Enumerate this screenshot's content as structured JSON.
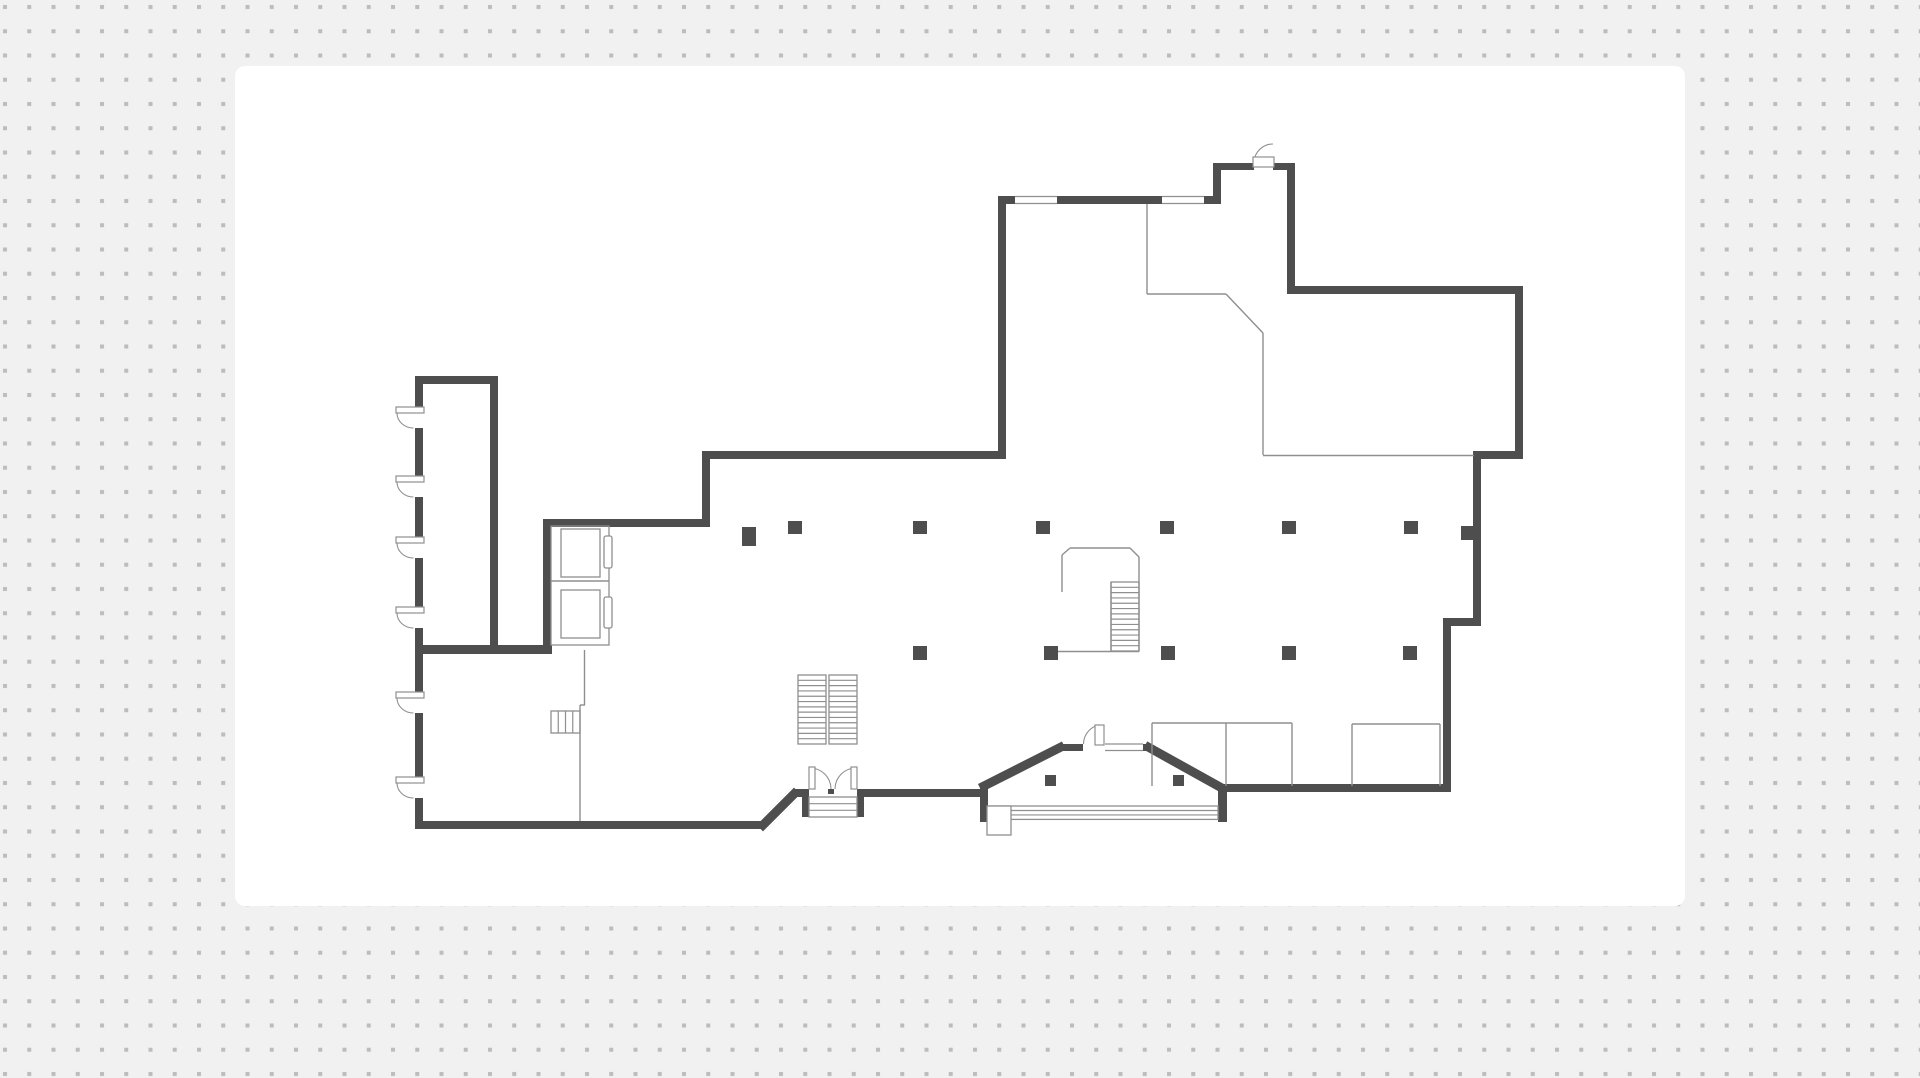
{
  "meta": {
    "width": 1920,
    "height": 1078,
    "description": "Floor plan drawing on a dotted design canvas"
  },
  "canvas": {
    "page_bg": "#f1f1f1",
    "dot_color": "#bcbcbc",
    "dot_size": 4,
    "dot_spacing": 24.25,
    "dot_offset_x": 3,
    "dot_offset_y": 5,
    "card": {
      "x": 235,
      "y": 66,
      "w": 1450,
      "h": 840,
      "radius": 10,
      "fill": "#ffffff"
    }
  },
  "floorplan": {
    "colors": {
      "wall": "#4e4e4e",
      "thin": "#8f8f8f",
      "fixture_fill": "#ffffff"
    },
    "walls": [
      [
        415,
        376,
        83,
        8
      ],
      [
        415,
        376,
        8,
        453
      ],
      [
        490,
        384,
        8,
        261
      ],
      [
        415,
        645,
        137,
        9
      ],
      [
        543,
        519,
        8,
        131
      ],
      [
        543,
        519,
        164,
        8
      ],
      [
        702,
        452,
        8,
        75
      ],
      [
        702,
        451,
        301,
        8
      ],
      [
        998,
        196,
        8,
        263
      ],
      [
        998,
        196,
        223,
        8
      ],
      [
        1213,
        163,
        8,
        41
      ],
      [
        1213,
        163,
        82,
        7
      ],
      [
        1287,
        163,
        8,
        131
      ],
      [
        1287,
        286,
        236,
        8
      ],
      [
        1515,
        286,
        8,
        173
      ],
      [
        1473,
        451,
        50,
        8
      ],
      [
        1473,
        451,
        8,
        175
      ],
      [
        1443,
        618,
        38,
        8
      ],
      [
        1443,
        618,
        8,
        174
      ],
      [
        1227,
        784,
        223,
        8
      ],
      [
        1218,
        784,
        9,
        38
      ],
      [
        1143,
        744,
        9,
        7
      ],
      [
        1060,
        744,
        23,
        7
      ],
      [
        980,
        788,
        8,
        34
      ],
      [
        864,
        789,
        116,
        8
      ],
      [
        857,
        789,
        7,
        28
      ],
      [
        802,
        789,
        7,
        28
      ],
      [
        793,
        789,
        9,
        8
      ],
      [
        415,
        821,
        348,
        8
      ],
      [
        828,
        789,
        6,
        5
      ]
    ],
    "wall_diagonals": [
      [
        763,
        825,
        794,
        794
      ],
      [
        984,
        786,
        1060,
        747.5
      ],
      [
        1149,
        747.5,
        1220,
        787
      ]
    ],
    "door_gaps": [
      [
        413,
        407,
        12,
        21
      ],
      [
        413,
        476,
        12,
        21
      ],
      [
        413,
        537,
        12,
        21
      ],
      [
        413,
        607,
        12,
        21
      ],
      [
        413,
        692,
        12,
        21
      ],
      [
        413,
        777,
        12,
        21
      ],
      [
        1254,
        162,
        19,
        9
      ],
      [
        1083,
        743,
        22,
        9
      ]
    ],
    "windows": [
      [
        1015,
        196.5,
        42,
        7
      ],
      [
        1162,
        196.5,
        42,
        7
      ],
      [
        1105,
        744,
        38,
        6.5
      ]
    ],
    "thin_lines": [
      [
        551,
        581,
        609,
        581
      ],
      [
        584.5,
        650,
        584.5,
        705
      ],
      [
        580,
        705,
        585,
        705
      ],
      [
        580,
        705,
        580,
        821
      ],
      [
        1152,
        723,
        1152,
        786
      ],
      [
        1152,
        723,
        1292,
        723
      ],
      [
        1226,
        723,
        1226,
        786
      ],
      [
        1292,
        723,
        1292,
        786
      ],
      [
        1352,
        724,
        1352,
        786
      ],
      [
        1352,
        724,
        1440,
        724
      ],
      [
        1440,
        724,
        1440,
        786
      ],
      [
        1147,
        204,
        1147,
        294
      ],
      [
        1147,
        294,
        1226,
        294
      ],
      [
        1226,
        294,
        1263,
        333
      ],
      [
        1263,
        333,
        1263,
        455
      ],
      [
        1263,
        455.5,
        1474,
        455.5
      ],
      [
        1062,
        555,
        1062,
        592
      ],
      [
        1062,
        555,
        1070,
        548
      ],
      [
        1070,
        548,
        1130,
        548
      ],
      [
        1130,
        548,
        1139,
        557
      ],
      [
        1139,
        557,
        1139,
        651
      ],
      [
        1058,
        651.5,
        1139,
        651.5
      ],
      [
        1111,
        582,
        1111,
        651
      ]
    ],
    "stairs": [
      {
        "x": 798,
        "y": 675,
        "w": 28,
        "h": 69,
        "n": 13,
        "dir": "h",
        "name": "stair-flight-left"
      },
      {
        "x": 829,
        "y": 675,
        "w": 28,
        "h": 69,
        "n": 13,
        "dir": "h",
        "name": "stair-flight-right"
      },
      {
        "x": 1111,
        "y": 582,
        "w": 28,
        "h": 69,
        "n": 13,
        "dir": "h",
        "name": "central-stair-treads"
      },
      {
        "x": 551,
        "y": 711,
        "w": 29,
        "h": 22,
        "n": 4,
        "dir": "v",
        "name": "service-stair"
      },
      {
        "x": 809,
        "y": 797,
        "w": 48,
        "h": 20,
        "n": 3,
        "dir": "h",
        "name": "entry-steps"
      },
      {
        "x": 990,
        "y": 806,
        "w": 228,
        "h": 13.4,
        "n": 3,
        "dir": "h",
        "name": "main-entrance-steps"
      }
    ],
    "fixtures": [
      {
        "x": 551,
        "y": 526,
        "w": 58,
        "h": 119,
        "fill": "none",
        "name": "elevator-shaft"
      },
      {
        "x": 561,
        "y": 529,
        "w": 39,
        "h": 48,
        "fill": "none",
        "name": "elevator-cab"
      },
      {
        "x": 561,
        "y": 590,
        "w": 39,
        "h": 48,
        "fill": "none",
        "name": "elevator-cab"
      },
      {
        "x": 604,
        "y": 536,
        "w": 8,
        "h": 32,
        "rx": 2,
        "fill": "#ffffff",
        "name": "elevator-door"
      },
      {
        "x": 604,
        "y": 597,
        "w": 8,
        "h": 31,
        "rx": 2,
        "fill": "#ffffff",
        "name": "elevator-door"
      },
      {
        "x": 987,
        "y": 806,
        "w": 24,
        "h": 29,
        "fill": "#ffffff",
        "name": "entrance-planter"
      }
    ],
    "swing_doors": [
      {
        "leaf": [
          396,
          407,
          28,
          6
        ],
        "arc": "M 397 413 A 16.5 15 0 0 0 413.5 428",
        "name": "door-left-1"
      },
      {
        "leaf": [
          396,
          476,
          28,
          6
        ],
        "arc": "M 397 482 A 16.5 15 0 0 0 413.5 497",
        "name": "door-left-2"
      },
      {
        "leaf": [
          396,
          537,
          28,
          6
        ],
        "arc": "M 397 543 A 16.5 15 0 0 0 413.5 558",
        "name": "door-left-3"
      },
      {
        "leaf": [
          396,
          607,
          28,
          6
        ],
        "arc": "M 397 613 A 16.5 15 0 0 0 413.5 628",
        "name": "door-left-4"
      },
      {
        "leaf": [
          396,
          692,
          28,
          6
        ],
        "arc": "M 397 698 A 16.5 15 0 0 0 413.5 713",
        "name": "door-left-5"
      },
      {
        "leaf": [
          396,
          777,
          28,
          6
        ],
        "arc": "M 397 783 A 16.5 15 0 0 0 413.5 798",
        "name": "door-left-6"
      },
      {
        "leaf": [
          1253,
          157,
          21,
          10
        ],
        "arc": "M 1254 162 A 19 19 0 0 1 1273 144",
        "name": "door-top"
      },
      {
        "leaf": [
          1095,
          725,
          9,
          20
        ],
        "arc": "M 1083.5 744 A 21 20 0 0 1 1095.5 726",
        "name": "door-bay"
      },
      {
        "leaf": [
          809,
          767,
          6,
          22
        ],
        "arc": "M 810 768 A 21 21 0 0 1 831 789",
        "name": "double-door-left-leaf"
      },
      {
        "leaf": [
          851,
          767,
          6,
          22
        ],
        "arc": "M 856 768 A 21 21 0 0 0 835 789",
        "name": "double-door-right-leaf"
      }
    ],
    "columns": [
      [
        742,
        527,
        14,
        19
      ],
      [
        788,
        521,
        14,
        13
      ],
      [
        913,
        521,
        14,
        13
      ],
      [
        1036,
        521,
        14,
        13
      ],
      [
        1160,
        521,
        14,
        13
      ],
      [
        1282,
        521,
        14,
        13
      ],
      [
        1404,
        521,
        14,
        13
      ],
      [
        1461,
        526,
        12,
        14
      ],
      [
        913,
        646,
        14,
        14
      ],
      [
        1044,
        646,
        14,
        14
      ],
      [
        1161,
        646,
        14,
        14
      ],
      [
        1282,
        646,
        14,
        14
      ],
      [
        1403,
        646,
        14,
        14
      ],
      [
        1045,
        775,
        11,
        11
      ],
      [
        1173,
        775,
        11,
        11
      ]
    ]
  }
}
